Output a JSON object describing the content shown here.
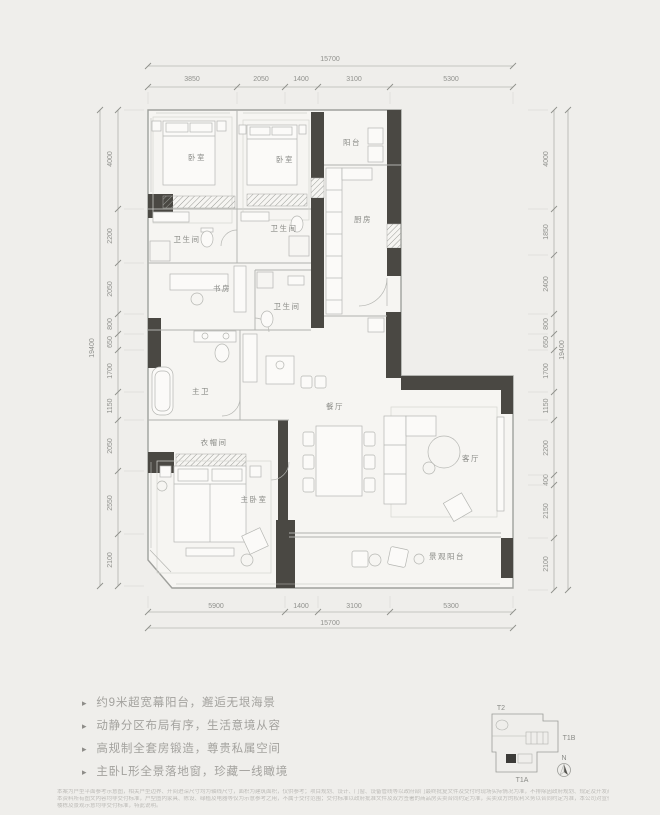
{
  "plan": {
    "rooms": [
      "卧室",
      "卧室",
      "阳台",
      "厨房",
      "卫生间",
      "卫生间",
      "书房",
      "卫生间",
      "主卫",
      "餐厅",
      "衣帽间",
      "主卧室",
      "客厅",
      "景观阳台"
    ],
    "dims": {
      "top": {
        "total": "15700",
        "segments": [
          "3850",
          "2050",
          "1400",
          "3100",
          "5300"
        ]
      },
      "bottom": {
        "total": "15700",
        "segments": [
          "5900",
          "1400",
          "3100",
          "5300"
        ]
      },
      "left": {
        "total": "19400",
        "segments": [
          "4000",
          "2200",
          "2050",
          "800",
          "650",
          "1700",
          "1150",
          "2050",
          "2550",
          "2100"
        ]
      },
      "right": {
        "total": "19400",
        "segments": [
          "4000",
          "1850",
          "2400",
          "800",
          "650",
          "1700",
          "1150",
          "2200",
          "400",
          "2150",
          "2100"
        ]
      }
    }
  },
  "features": {
    "bullet": "▸",
    "items": [
      "约9米超宽幕阳台，邂逅无垠海景",
      "动静分区布局有序，生活意境从容",
      "高规制全套房锻造，尊贵私属空间",
      "主卧L形全景落地窗，珍藏一线瞰境"
    ]
  },
  "keyplan": {
    "t2": "T2",
    "t1b": "T1B",
    "t1a": "T1A",
    "north": "N"
  },
  "disclaimer": {
    "lines": [
      "本案为户型平面参考示意图，相关户型边界、开间进深尺寸均为轴线尺寸，面积为建筑面积，仅供参考；项目规划、设计、门窗、设备管线等以政府部门最终批复文件及交付时现场实际情况为准，不排除因政府规划、规定及开发商未能控制的原因发生变化的可能，本公司保留在法律允许范围内对宣传资料进行修改的权利。",
      "本资料所有图文内容均非交付标准，户型图内家具、陈设、绿植及电器等仅为示意参考之用，不属于交付范围；交付标准以政府批准文件及双方签署的商品房买卖合同约定为准，买卖双方的权利义务以合同约定为准，本公司对宣传资料在法律允许范围内保留解释权利，敬请留意最新资料。",
      "楼栋及景观示意均非交付标准，特此说明。"
    ]
  }
}
